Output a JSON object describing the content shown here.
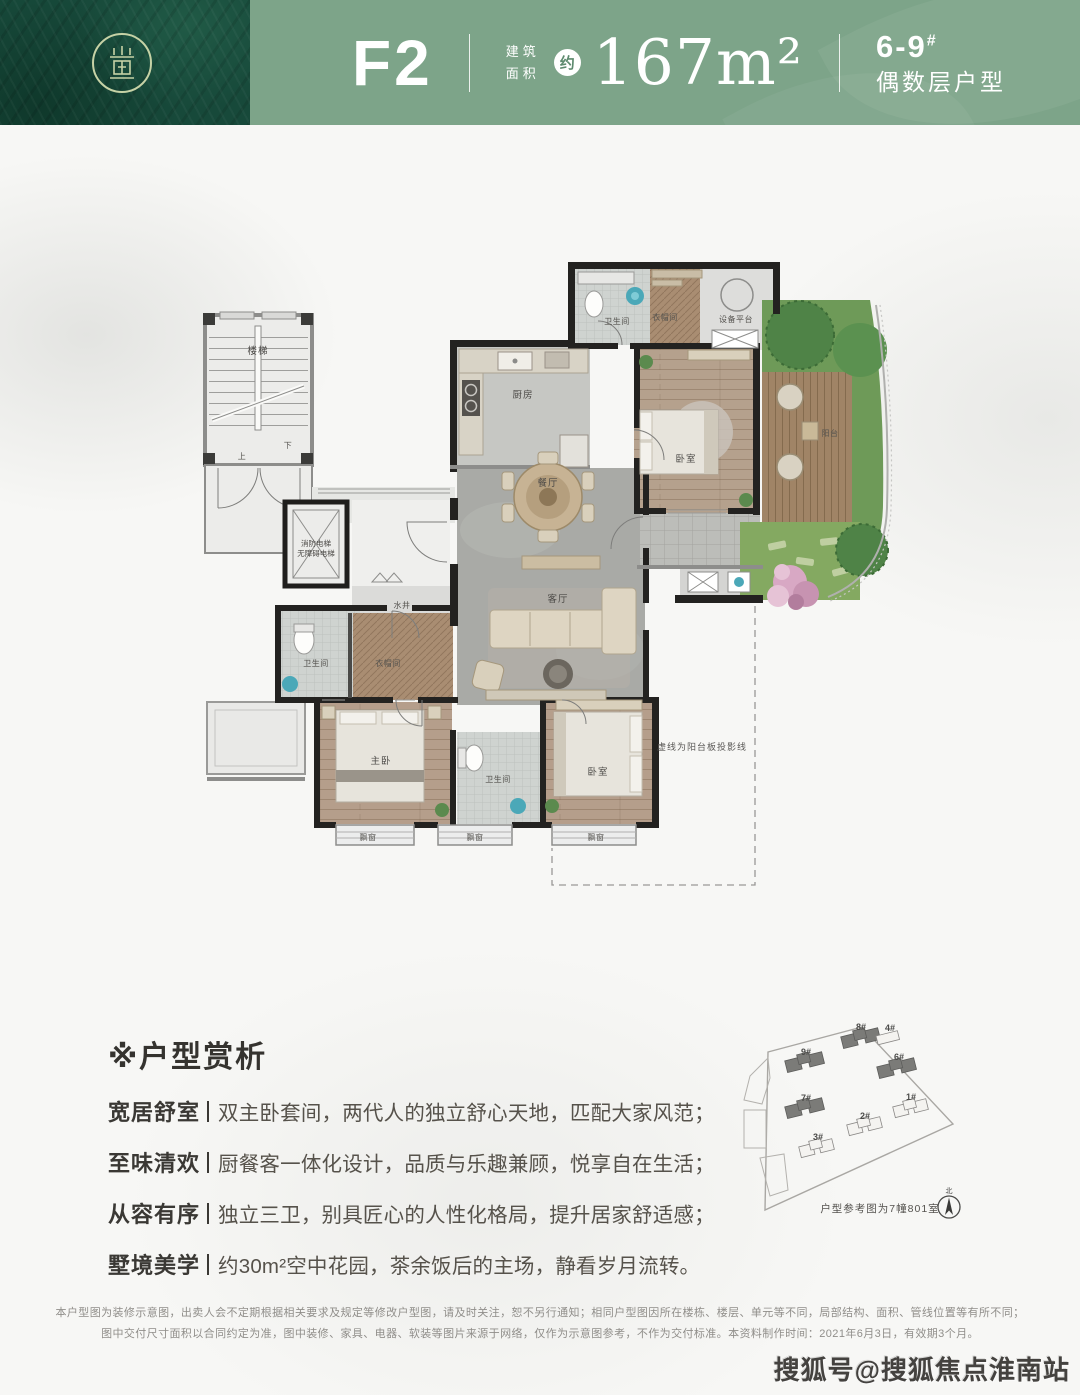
{
  "header": {
    "unit_code": "F2",
    "area_label_1": "建筑",
    "area_label_2": "面积",
    "approx": "约",
    "area_value": "167m²",
    "building_no": "6-9",
    "building_sup": "#",
    "building_note": "偶数层户型",
    "colors": {
      "brand_dark_green": "#17493a",
      "brand_sage": "#7da489",
      "logo_gold": "#c6d2a6"
    }
  },
  "floorplan": {
    "labels": {
      "stairs": "楼梯",
      "up": "上",
      "down": "下",
      "elevator1": "消防电梯",
      "elevator2": "无障碍电梯",
      "shaft": "水井",
      "kitchen": "厨房",
      "dining": "餐厅",
      "living": "客厅",
      "bathroom": "卫生间",
      "closet": "衣帽间",
      "master": "主卧",
      "bedroom": "卧室",
      "equipment": "设备平台",
      "balcony": "阳台",
      "bay_window": "飘窗",
      "annotation": "虚线为阳台板投影线"
    }
  },
  "analysis": {
    "title": "※户型赏析",
    "items": [
      {
        "label": "宽居舒室",
        "text": "双主卧套间，两代人的独立舒心天地，匹配大家风范；"
      },
      {
        "label": "至味清欢",
        "text": "厨餐客一体化设计，品质与乐趣兼顾，悦享自在生活；"
      },
      {
        "label": "从容有序",
        "text": "独立三卫，别具匠心的人性化格局，提升居家舒适感；"
      },
      {
        "label": "墅境美学",
        "text": "约30m²空中花园，茶余饭后的主场，静看岁月流转。"
      }
    ]
  },
  "siteplan": {
    "caption": "户型参考图为7幢801室",
    "compass": "北",
    "buildings": [
      {
        "name": "8#",
        "highlighted": true
      },
      {
        "name": "4#",
        "highlighted": false
      },
      {
        "name": "9#",
        "highlighted": true
      },
      {
        "name": "6#",
        "highlighted": true
      },
      {
        "name": "7#",
        "highlighted": true
      },
      {
        "name": "1#",
        "highlighted": false
      },
      {
        "name": "2#",
        "highlighted": false
      },
      {
        "name": "3#",
        "highlighted": false
      }
    ]
  },
  "disclaimer": {
    "line1": "本户型图为装修示意图，出卖人会不定期根据相关要求及规定等修改户型图，请及时关注，恕不另行通知；相同户型图因所在楼栋、楼层、单元等不同，局部结构、面积、管线位置等有所不同；",
    "line2": "图中交付尺寸面积以合同约定为准，图中装修、家具、电器、软装等图片来源于网络，仅作为示意图参考，不作为交付标准。本资料制作时间：2021年6月3日，有效期3个月。"
  },
  "watermark": {
    "text": "搜狐号@搜狐焦点淮南站"
  }
}
